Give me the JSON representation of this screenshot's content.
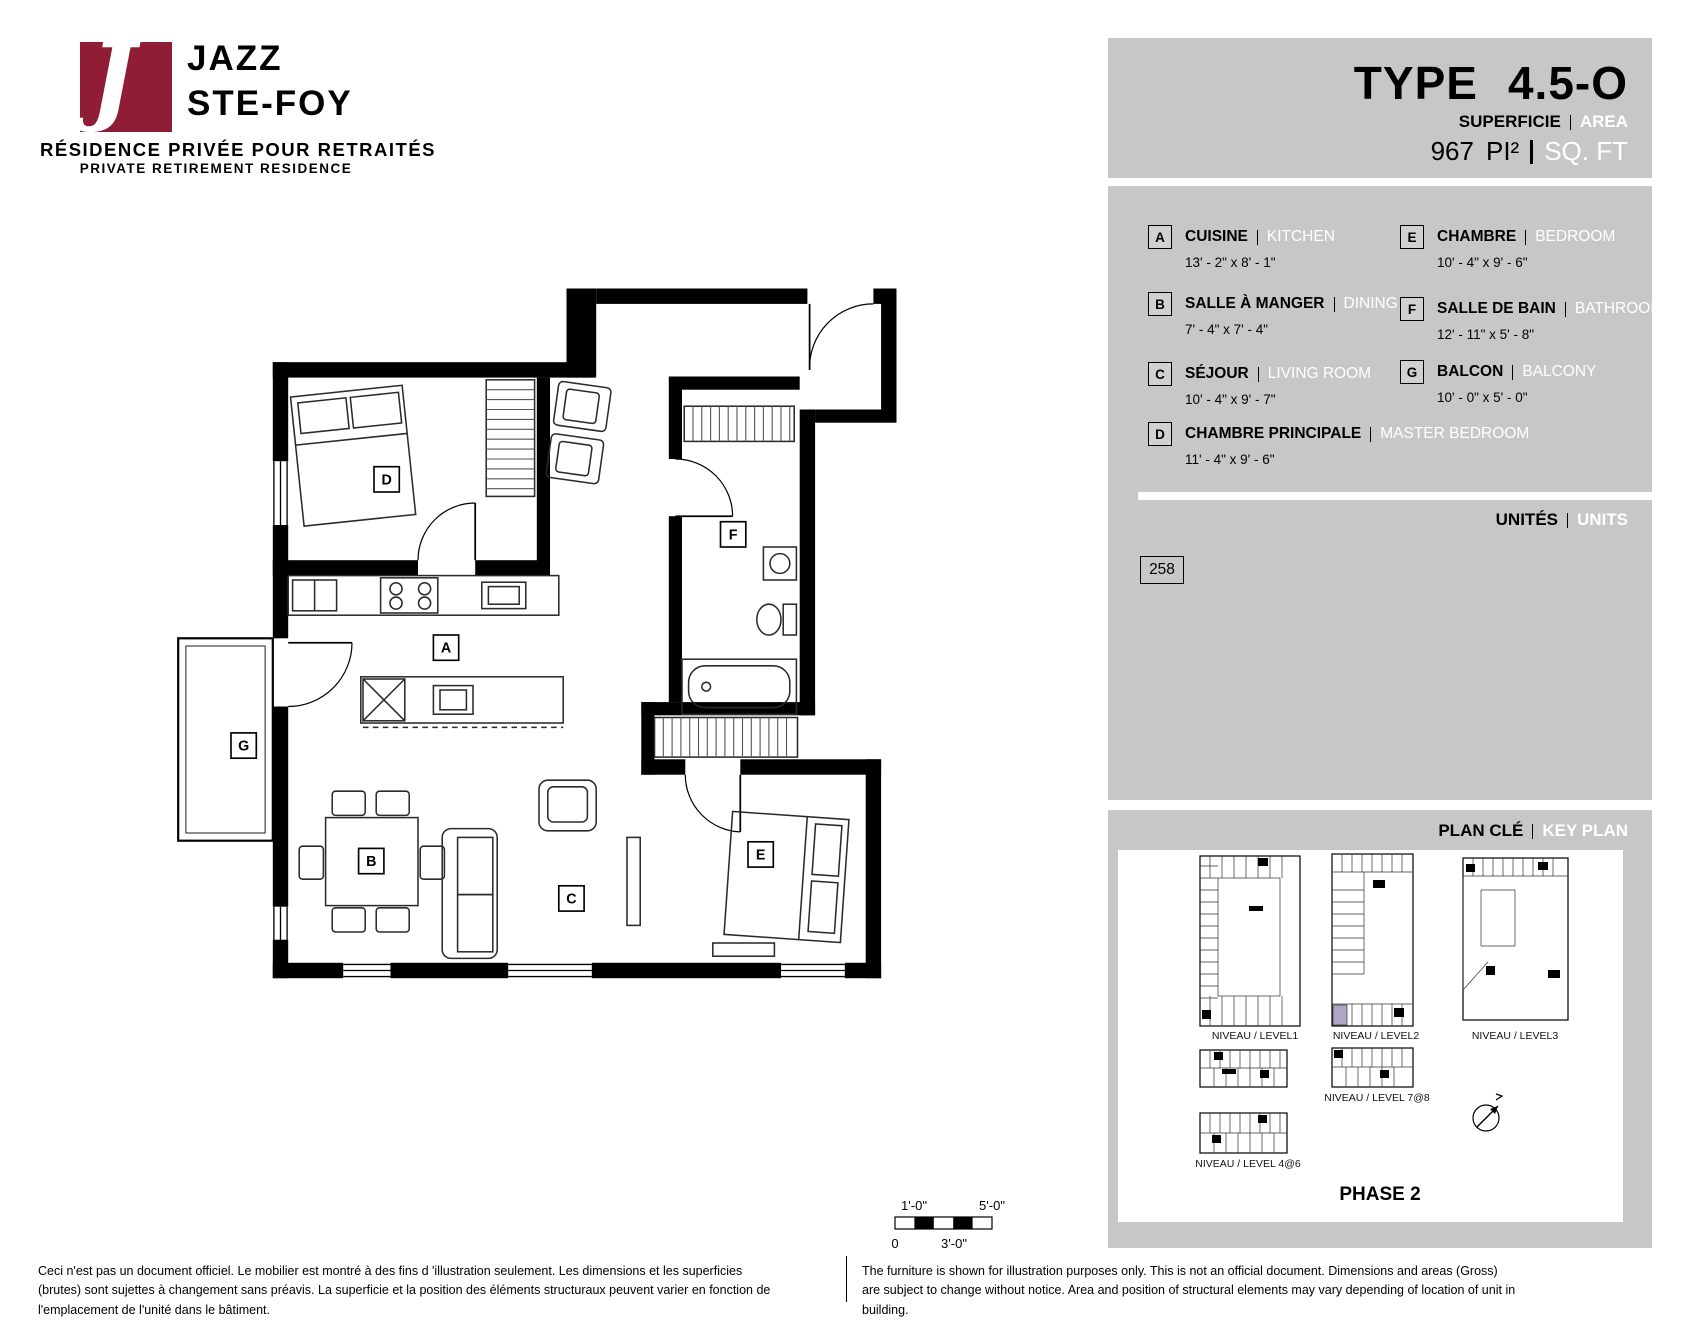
{
  "logo": {
    "monogram": "J",
    "name_line1": "JAZZ",
    "name_line2": "STE-FOY",
    "tagline_fr": "RÉSIDENCE PRIVÉE POUR RETRAITÉS",
    "tagline_en": "PRIVATE RETIREMENT RESIDENCE",
    "brand_color": "#8e1d35"
  },
  "header": {
    "type_label": "TYPE",
    "type_value": "4.5-O",
    "area_label_fr": "SUPERFICIE",
    "area_label_en": "AREA",
    "area_value": "967",
    "area_unit_fr": "PI²",
    "area_unit_en": "SQ. FT"
  },
  "legend": {
    "rooms": [
      {
        "id": "A",
        "name_fr": "CUISINE",
        "name_en": "KITCHEN",
        "dims": "13' - 2\" x 8' - 1\""
      },
      {
        "id": "B",
        "name_fr": "SALLE À MANGER",
        "name_en": "DINING",
        "dims": "7' - 4\" x 7' - 4\""
      },
      {
        "id": "C",
        "name_fr": "SÉJOUR",
        "name_en": "LIVING ROOM",
        "dims": "10' - 4\" x 9' - 7\""
      },
      {
        "id": "D",
        "name_fr": "CHAMBRE PRINCIPALE",
        "name_en": "MASTER BEDROOM",
        "dims": "11' - 4\" x 9' - 6\""
      },
      {
        "id": "E",
        "name_fr": "CHAMBRE",
        "name_en": "BEDROOM",
        "dims": "10' - 4\" x 9' - 6\""
      },
      {
        "id": "F",
        "name_fr": "SALLE DE BAIN",
        "name_en": "BATHROOM",
        "dims": "12' - 11\" x 5' - 8\""
      },
      {
        "id": "G",
        "name_fr": "BALCON",
        "name_en": "BALCONY",
        "dims": "10' - 0\" x 5' - 0\""
      }
    ]
  },
  "units": {
    "label_fr": "UNITÉS",
    "label_en": "UNITS",
    "unit_number": "258"
  },
  "keyplan": {
    "label_fr": "PLAN CLÉ",
    "label_en": "KEY PLAN",
    "levels": [
      "NIVEAU / LEVEL1",
      "NIVEAU / LEVEL2",
      "NIVEAU / LEVEL3",
      "NIVEAU / LEVEL 7@8",
      "NIVEAU / LEVEL 4@6"
    ],
    "phase": "PHASE 2",
    "highlight_color": "#b1a5c4"
  },
  "scalebar": {
    "tick_1ft": "1'-0\"",
    "tick_5ft": "5'-0\"",
    "tick_0": "0",
    "tick_3ft": "3'-0\""
  },
  "footer": {
    "disclaimer_fr": "Ceci n'est pas un document officiel.  Le mobilier est montré à des fins d 'illustration seulement.  Les dimensions et les superficies (brutes) sont sujettes à changement sans préavis. La superficie et la position des éléments structuraux peuvent varier en fonction de l'emplacement de l'unité dans le bâtiment.",
    "disclaimer_en": "The furniture is shown for illustration purposes only.  This is not an official document.  Dimensions and areas (Gross) are subject to change without notice. Area and position of structural elements may vary depending of location of unit in building."
  }
}
